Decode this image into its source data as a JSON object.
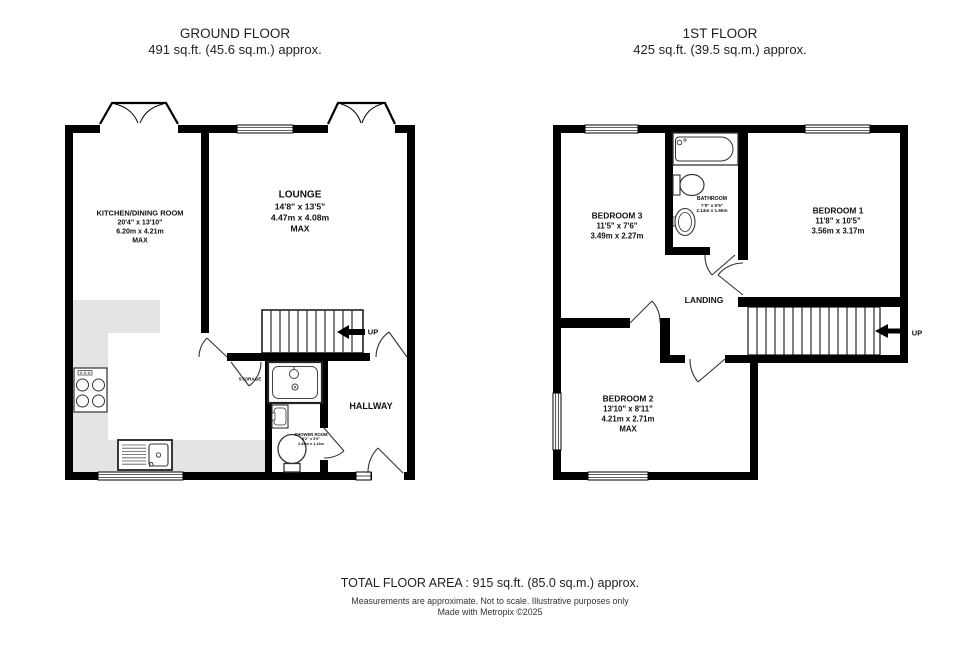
{
  "ground_floor": {
    "title": "GROUND FLOOR",
    "area": "491 sq.ft. (45.6 sq.m.) approx.",
    "up_label": "UP",
    "rooms": {
      "kitchen": {
        "name": "KITCHEN/DINING ROOM",
        "imperial": "20'4\" x 13'10\"",
        "metric": "6.20m x 4.21m",
        "note": "MAX"
      },
      "lounge": {
        "name": "LOUNGE",
        "imperial": "14'8\" x 13'5\"",
        "metric": "4.47m x 4.08m",
        "note": "MAX"
      },
      "hallway": {
        "name": "HALLWAY"
      },
      "storage": {
        "name": "STORAGE"
      },
      "shower_room": {
        "name": "SHOWER ROOM",
        "imperial": "8'2\" x 3'9\"",
        "metric": "2.49m x 1.14m"
      }
    }
  },
  "first_floor": {
    "title": "1ST FLOOR",
    "area": "425 sq.ft. (39.5 sq.m.) approx.",
    "up_label": "UP",
    "rooms": {
      "bedroom1": {
        "name": "BEDROOM 1",
        "imperial": "11'8\" x 10'5\"",
        "metric": "3.56m x 3.17m"
      },
      "bedroom2": {
        "name": "BEDROOM 2",
        "imperial": "13'10\" x 8'11\"",
        "metric": "4.21m x 2.71m",
        "note": "MAX"
      },
      "bedroom3": {
        "name": "BEDROOM 3",
        "imperial": "11'5\" x 7'6\"",
        "metric": "3.49m x 2.27m"
      },
      "bathroom": {
        "name": "BATHROOM",
        "imperial": "7'0\" x 5'5\"",
        "metric": "2.14m x 1.65m"
      },
      "landing": {
        "name": "LANDING"
      }
    }
  },
  "footer": {
    "total": "TOTAL FLOOR AREA : 915 sq.ft. (85.0 sq.m.) approx.",
    "disclaimer": "Measurements are approximate.  Not to scale.  Illustrative purposes only",
    "credit": "Made with Metropix ©2025"
  },
  "colors": {
    "wall": "#000000",
    "counter": "#e4e4e4",
    "text": "#1a1a1a",
    "background": "#ffffff"
  }
}
